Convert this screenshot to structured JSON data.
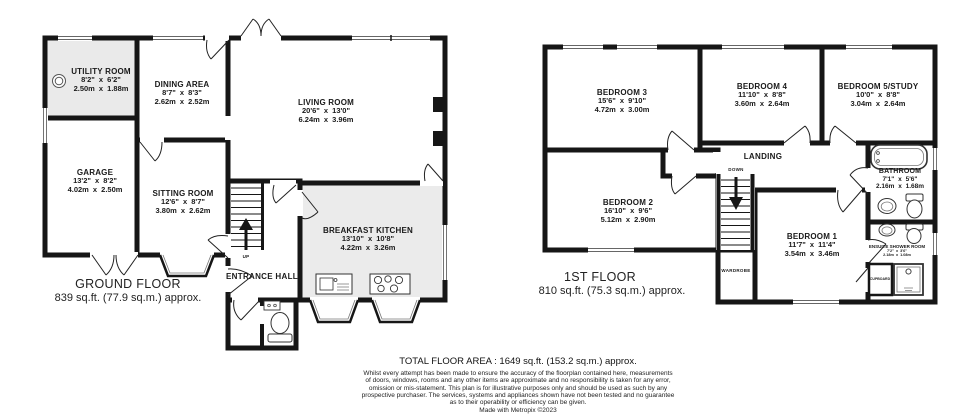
{
  "meta": {
    "type": "floorplan",
    "wall_color": "#161616",
    "floor_gray": "#ebebeb",
    "background": "#ffffff"
  },
  "ground": {
    "title": "GROUND FLOOR",
    "area": "839 sq.ft. (77.9 sq.m.) approx.",
    "labels": {
      "entrance_hall": "ENTRANCE HALL",
      "up": "UP"
    },
    "rooms": {
      "utility": {
        "name": "UTILITY ROOM",
        "imperial": "8'2\" x 6'2\"",
        "metric": "2.50m x 1.88m"
      },
      "dining": {
        "name": "DINING AREA",
        "imperial": "8'7\" x 8'3\"",
        "metric": "2.62m x 2.52m"
      },
      "living": {
        "name": "LIVING ROOM",
        "imperial": "20'6\" x 13'0\"",
        "metric": "6.24m x 3.96m"
      },
      "garage": {
        "name": "GARAGE",
        "imperial": "13'2\" x 8'2\"",
        "metric": "4.02m x 2.50m"
      },
      "sitting": {
        "name": "SITTING ROOM",
        "imperial": "12'6\" x 8'7\"",
        "metric": "3.80m x 2.62m"
      },
      "kitchen": {
        "name": "BREAKFAST KITCHEN",
        "imperial": "13'10\" x 10'8\"",
        "metric": "4.22m x 3.26m"
      }
    }
  },
  "first": {
    "title": "1ST FLOOR",
    "area": "810 sq.ft. (75.3 sq.m.) approx.",
    "labels": {
      "landing": "LANDING",
      "down": "DOWN",
      "wardrobe": "WARDROBE",
      "cupboard": "CUPBOARD"
    },
    "rooms": {
      "bedroom3": {
        "name": "BEDROOM 3",
        "imperial": "15'6\" x 9'10\"",
        "metric": "4.72m x 3.00m"
      },
      "bedroom4": {
        "name": "BEDROOM 4",
        "imperial": "11'10\" x 8'8\"",
        "metric": "3.60m x 2.64m"
      },
      "bedroom5": {
        "name": "BEDROOM 5/STUDY",
        "imperial": "10'0\" x 8'8\"",
        "metric": "3.04m x 2.64m"
      },
      "bedroom2": {
        "name": "BEDROOM 2",
        "imperial": "16'10\" x 9'6\"",
        "metric": "5.12m x 2.90m"
      },
      "bedroom1": {
        "name": "BEDROOM 1",
        "imperial": "11'7\" x 11'4\"",
        "metric": "3.54m x 3.46m"
      },
      "bathroom": {
        "name": "BATHROOM",
        "imperial": "7'1\" x 5'6\"",
        "metric": "2.16m x 1.68m"
      },
      "ensuite": {
        "name": "ENSUITE SHOWER ROOM",
        "imperial": "7'2\" x 3'6\"",
        "metric": "2.18m x 1.08m"
      }
    }
  },
  "footer": {
    "total": "TOTAL FLOOR AREA : 1649 sq.ft. (153.2 sq.m.) approx.",
    "disclaimer": [
      "Whilst every attempt has been made to ensure the accuracy of the floorplan contained here, measurements",
      "of doors, windows, rooms and any other items are approximate and no responsibility is taken for any error,",
      "omission or mis-statement. This plan is for illustrative purposes only and should be used as such by any",
      "prospective purchaser. The services, systems and appliances shown have not been tested and no guarantee",
      "as to their operability or efficiency can be given."
    ],
    "credit": "Made with Metropix ©2023"
  }
}
